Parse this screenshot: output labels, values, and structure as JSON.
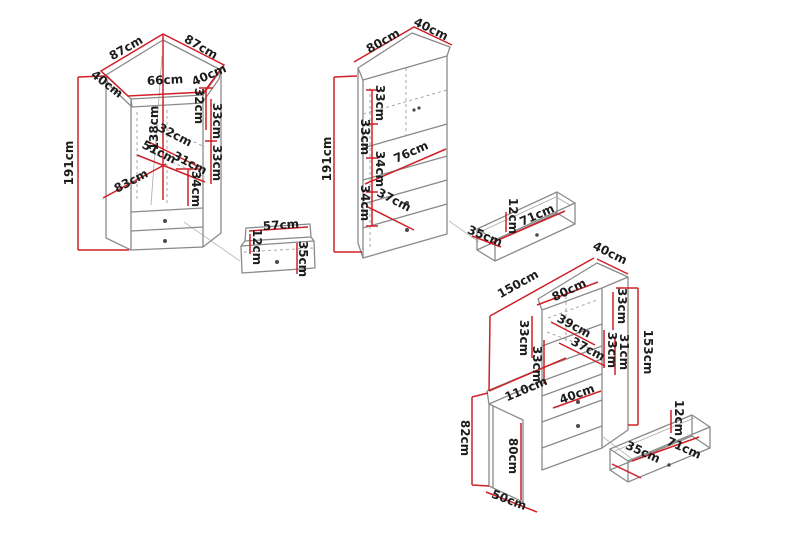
{
  "title": "Furniture dimension diagram",
  "units": "cm",
  "colors": {
    "dimension_line": "#cf2127",
    "outline": "#8a8a8a",
    "label_text": "#1c1c1c",
    "background": "#ffffff"
  },
  "pieces": {
    "corner_wardrobe": {
      "name": "corner-wardrobe",
      "dims": [
        "87cm",
        "87cm",
        "40cm",
        "66cm",
        "40cm",
        "191cm",
        "138cm",
        "32cm",
        "33cm",
        "33cm",
        "32cm",
        "51cm",
        "31cm",
        "83cm",
        "34cm"
      ]
    },
    "corner_wardrobe_drawer": {
      "name": "corner-wardrobe-drawer-detail",
      "dims": [
        "57cm",
        "12cm",
        "35cm"
      ]
    },
    "tall_cabinet": {
      "name": "tall-cabinet",
      "dims": [
        "80cm",
        "40cm",
        "191cm",
        "33cm",
        "33cm",
        "34cm",
        "34cm",
        "76cm",
        "37cm"
      ]
    },
    "tall_cabinet_drawer": {
      "name": "tall-cabinet-drawer-detail",
      "dims": [
        "12cm",
        "71cm",
        "35cm"
      ]
    },
    "desk_unit": {
      "name": "desk-with-hutch",
      "dims": [
        "150cm",
        "80cm",
        "40cm",
        "33cm",
        "31cm",
        "153cm",
        "39cm",
        "37cm",
        "33cm",
        "33cm",
        "33cm",
        "110cm",
        "40cm",
        "82cm",
        "80cm",
        "50cm"
      ]
    },
    "desk_drawer": {
      "name": "desk-drawer-detail",
      "dims": [
        "12cm",
        "35cm",
        "71cm"
      ]
    }
  }
}
